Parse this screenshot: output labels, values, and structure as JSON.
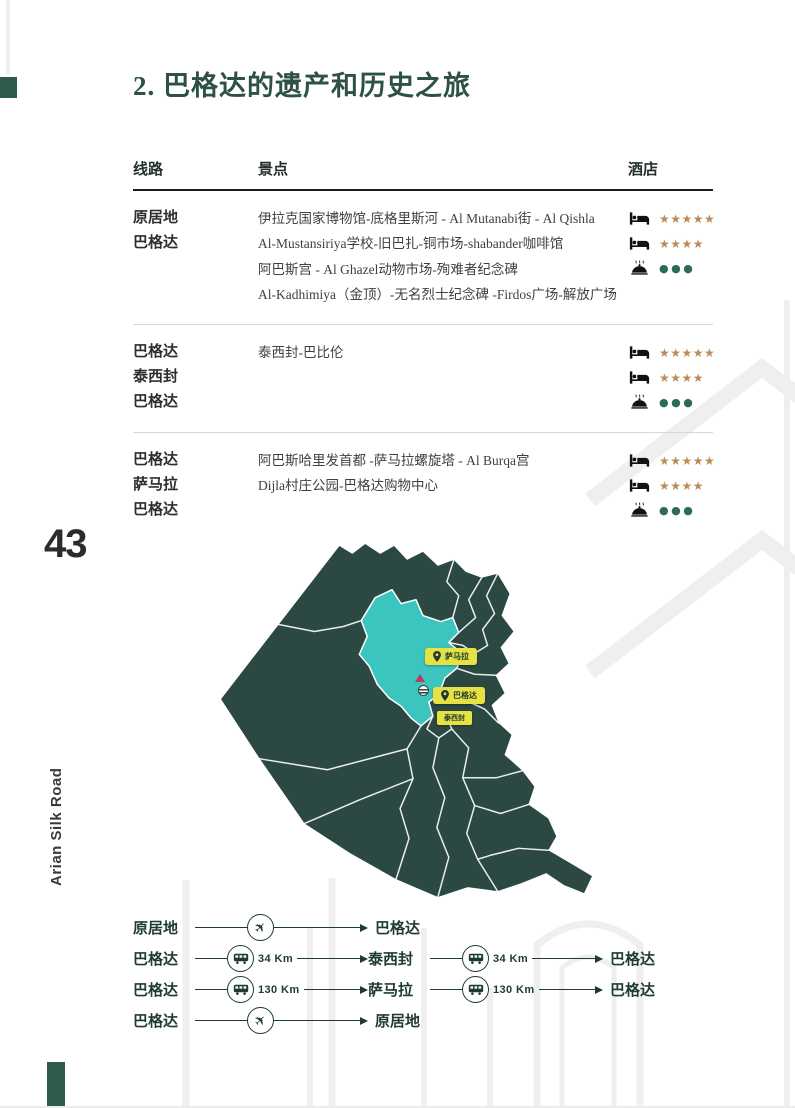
{
  "page": {
    "number": "43",
    "side_label": "Arian Silk Road",
    "title": "2. 巴格达的遗产和历史之旅"
  },
  "colors": {
    "accent_green": "#2f5a4e",
    "title_green": "#2d5244",
    "map_dark": "#2b4842",
    "map_highlight": "#3cc4bf",
    "label_yellow": "#e6e243",
    "star_gold": "#bd8b58",
    "dot_green": "#2e6a5b",
    "route_green": "#1e3b33"
  },
  "table": {
    "headers": {
      "route": "线路",
      "attractions": "景点",
      "hotels": "酒店"
    },
    "rows": [
      {
        "route": [
          "原居地",
          "巴格达"
        ],
        "attractions": [
          "伊拉克国家博物馆-底格里斯河 - Al Mutanabi街 - Al Qishla",
          "Al-Mustansiriya学校-旧巴扎-铜市场-shabander咖啡馆",
          "阿巴斯宫 - Al Ghazel动物市场-殉难者纪念碑",
          "Al-Kadhimiya（金顶）-无名烈士纪念碑 -Firdos广场-解放广场"
        ],
        "hotels": [
          {
            "icon": "bed",
            "rating": "★★★★★"
          },
          {
            "icon": "bed",
            "rating": "★★★★"
          },
          {
            "icon": "restaurant",
            "rating": "●●●"
          }
        ]
      },
      {
        "route": [
          "巴格达",
          "泰西封",
          "巴格达"
        ],
        "attractions": [
          "泰西封-巴比伦"
        ],
        "hotels": [
          {
            "icon": "bed",
            "rating": "★★★★★"
          },
          {
            "icon": "bed",
            "rating": "★★★★"
          },
          {
            "icon": "restaurant",
            "rating": "●●●"
          }
        ]
      },
      {
        "route": [
          "巴格达",
          "萨马拉",
          "巴格达"
        ],
        "attractions": [
          "阿巴斯哈里发首都 -萨马拉螺旋塔 - Al Burqa宫",
          "Dijla村庄公园-巴格达购物中心"
        ],
        "hotels": [
          {
            "icon": "bed",
            "rating": "★★★★★"
          },
          {
            "icon": "bed",
            "rating": "★★★★"
          },
          {
            "icon": "restaurant",
            "rating": "●●●"
          }
        ]
      }
    ]
  },
  "map": {
    "labels": {
      "samarra": "萨马拉",
      "baghdad": "巴格达",
      "ctesiphon": "泰西封"
    }
  },
  "transfers": {
    "plane_glyph": "✈",
    "rows": [
      {
        "from": "原居地",
        "leg1": {
          "mode": "plane",
          "distance": "",
          "to": "巴格达"
        }
      },
      {
        "from": "巴格达",
        "leg1": {
          "mode": "bus",
          "distance": "34 Km",
          "to": "泰西封"
        },
        "leg2": {
          "mode": "bus",
          "distance": "34 Km",
          "to": "巴格达"
        }
      },
      {
        "from": "巴格达",
        "leg1": {
          "mode": "bus",
          "distance": "130 Km",
          "to": "萨马拉"
        },
        "leg2": {
          "mode": "bus",
          "distance": "130 Km",
          "to": "巴格达"
        }
      },
      {
        "from": "巴格达",
        "leg1": {
          "mode": "plane",
          "distance": "",
          "to": "原居地"
        }
      }
    ]
  }
}
